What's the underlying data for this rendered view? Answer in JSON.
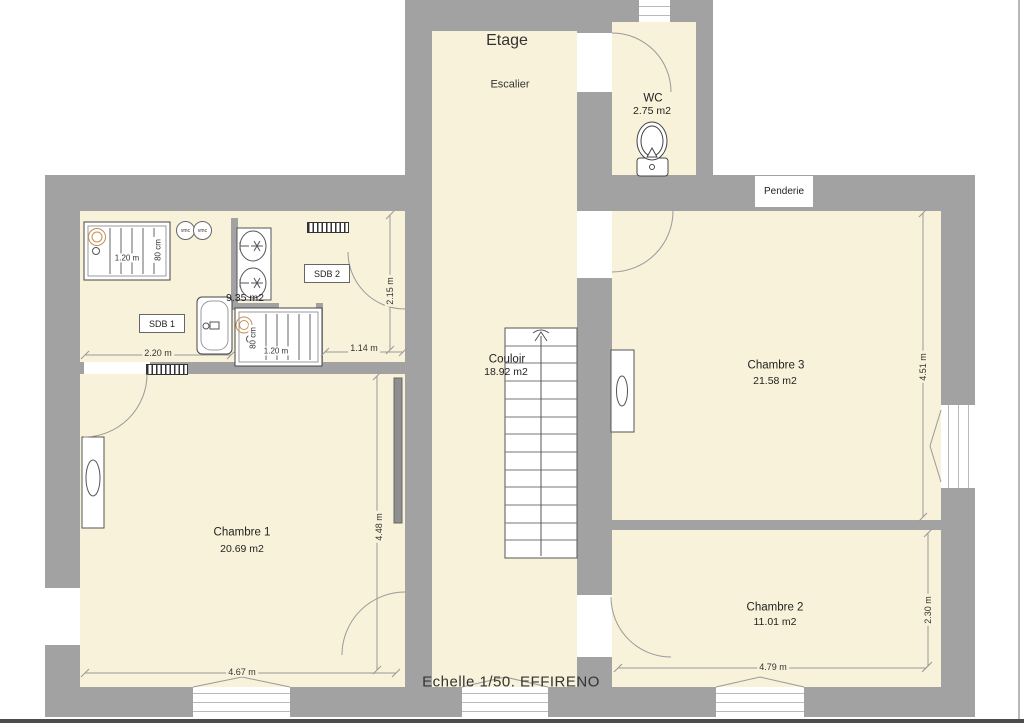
{
  "palette": {
    "wall_gray": "#a2a2a2",
    "floor_cream": "#f8f2da",
    "fixture_line": "#555555",
    "dim_line": "#999999",
    "shower_head_tan": "#c49057",
    "text": "#222222"
  },
  "title": {
    "floor_label": "Etage"
  },
  "rooms": {
    "escalier": {
      "name": "Escalier"
    },
    "couloir": {
      "name": "Couloir",
      "area": "18.92 m2"
    },
    "wc": {
      "name": "WC",
      "area": "2.75 m2"
    },
    "penderie": {
      "name": "Penderie"
    },
    "sdb1": {
      "name": "SDB 1"
    },
    "sdb2": {
      "name": "SDB 2",
      "area": "9.35 m2"
    },
    "chambre1": {
      "name": "Chambre 1",
      "area": "20.69 m2"
    },
    "chambre2": {
      "name": "Chambre 2",
      "area": "11.01 m2"
    },
    "chambre3": {
      "name": "Chambre 3",
      "area": "21.58 m2"
    }
  },
  "dimensions": {
    "sdb1_width": "2.20 m",
    "sdb2_clearance": "1.14 m",
    "sdb2_depth": "2.15 m",
    "chambre1_width": "4.67 m",
    "chambre1_depth": "4.48 m",
    "chambre2_width": "4.79 m",
    "chambre2_depth": "2.30 m",
    "chambre3_depth": "4.51 m",
    "shower_top_width": "1.20 m",
    "shower_top_depth": "80 cm",
    "shower_bottom_width": "1.20 m",
    "shower_bottom_depth": "80 cm"
  },
  "annotations": {
    "vmc_left": "vmc",
    "vmc_right": "vmc",
    "scale_note": "Echelle 1/50. EFFIRENO"
  },
  "icons": {
    "toilet": "toilet-icon",
    "shower_head": "shower-head-icon",
    "drain": "drain-icon",
    "sink_basin": "sink-basin-icon",
    "bathtub": "bathtub-icon",
    "radiator": "radiator-icon",
    "stairs": "stairs-icon",
    "door_swing": "door-swing-arc",
    "window": "window-icon",
    "vmc_vent": "vmc-vent-icon"
  }
}
